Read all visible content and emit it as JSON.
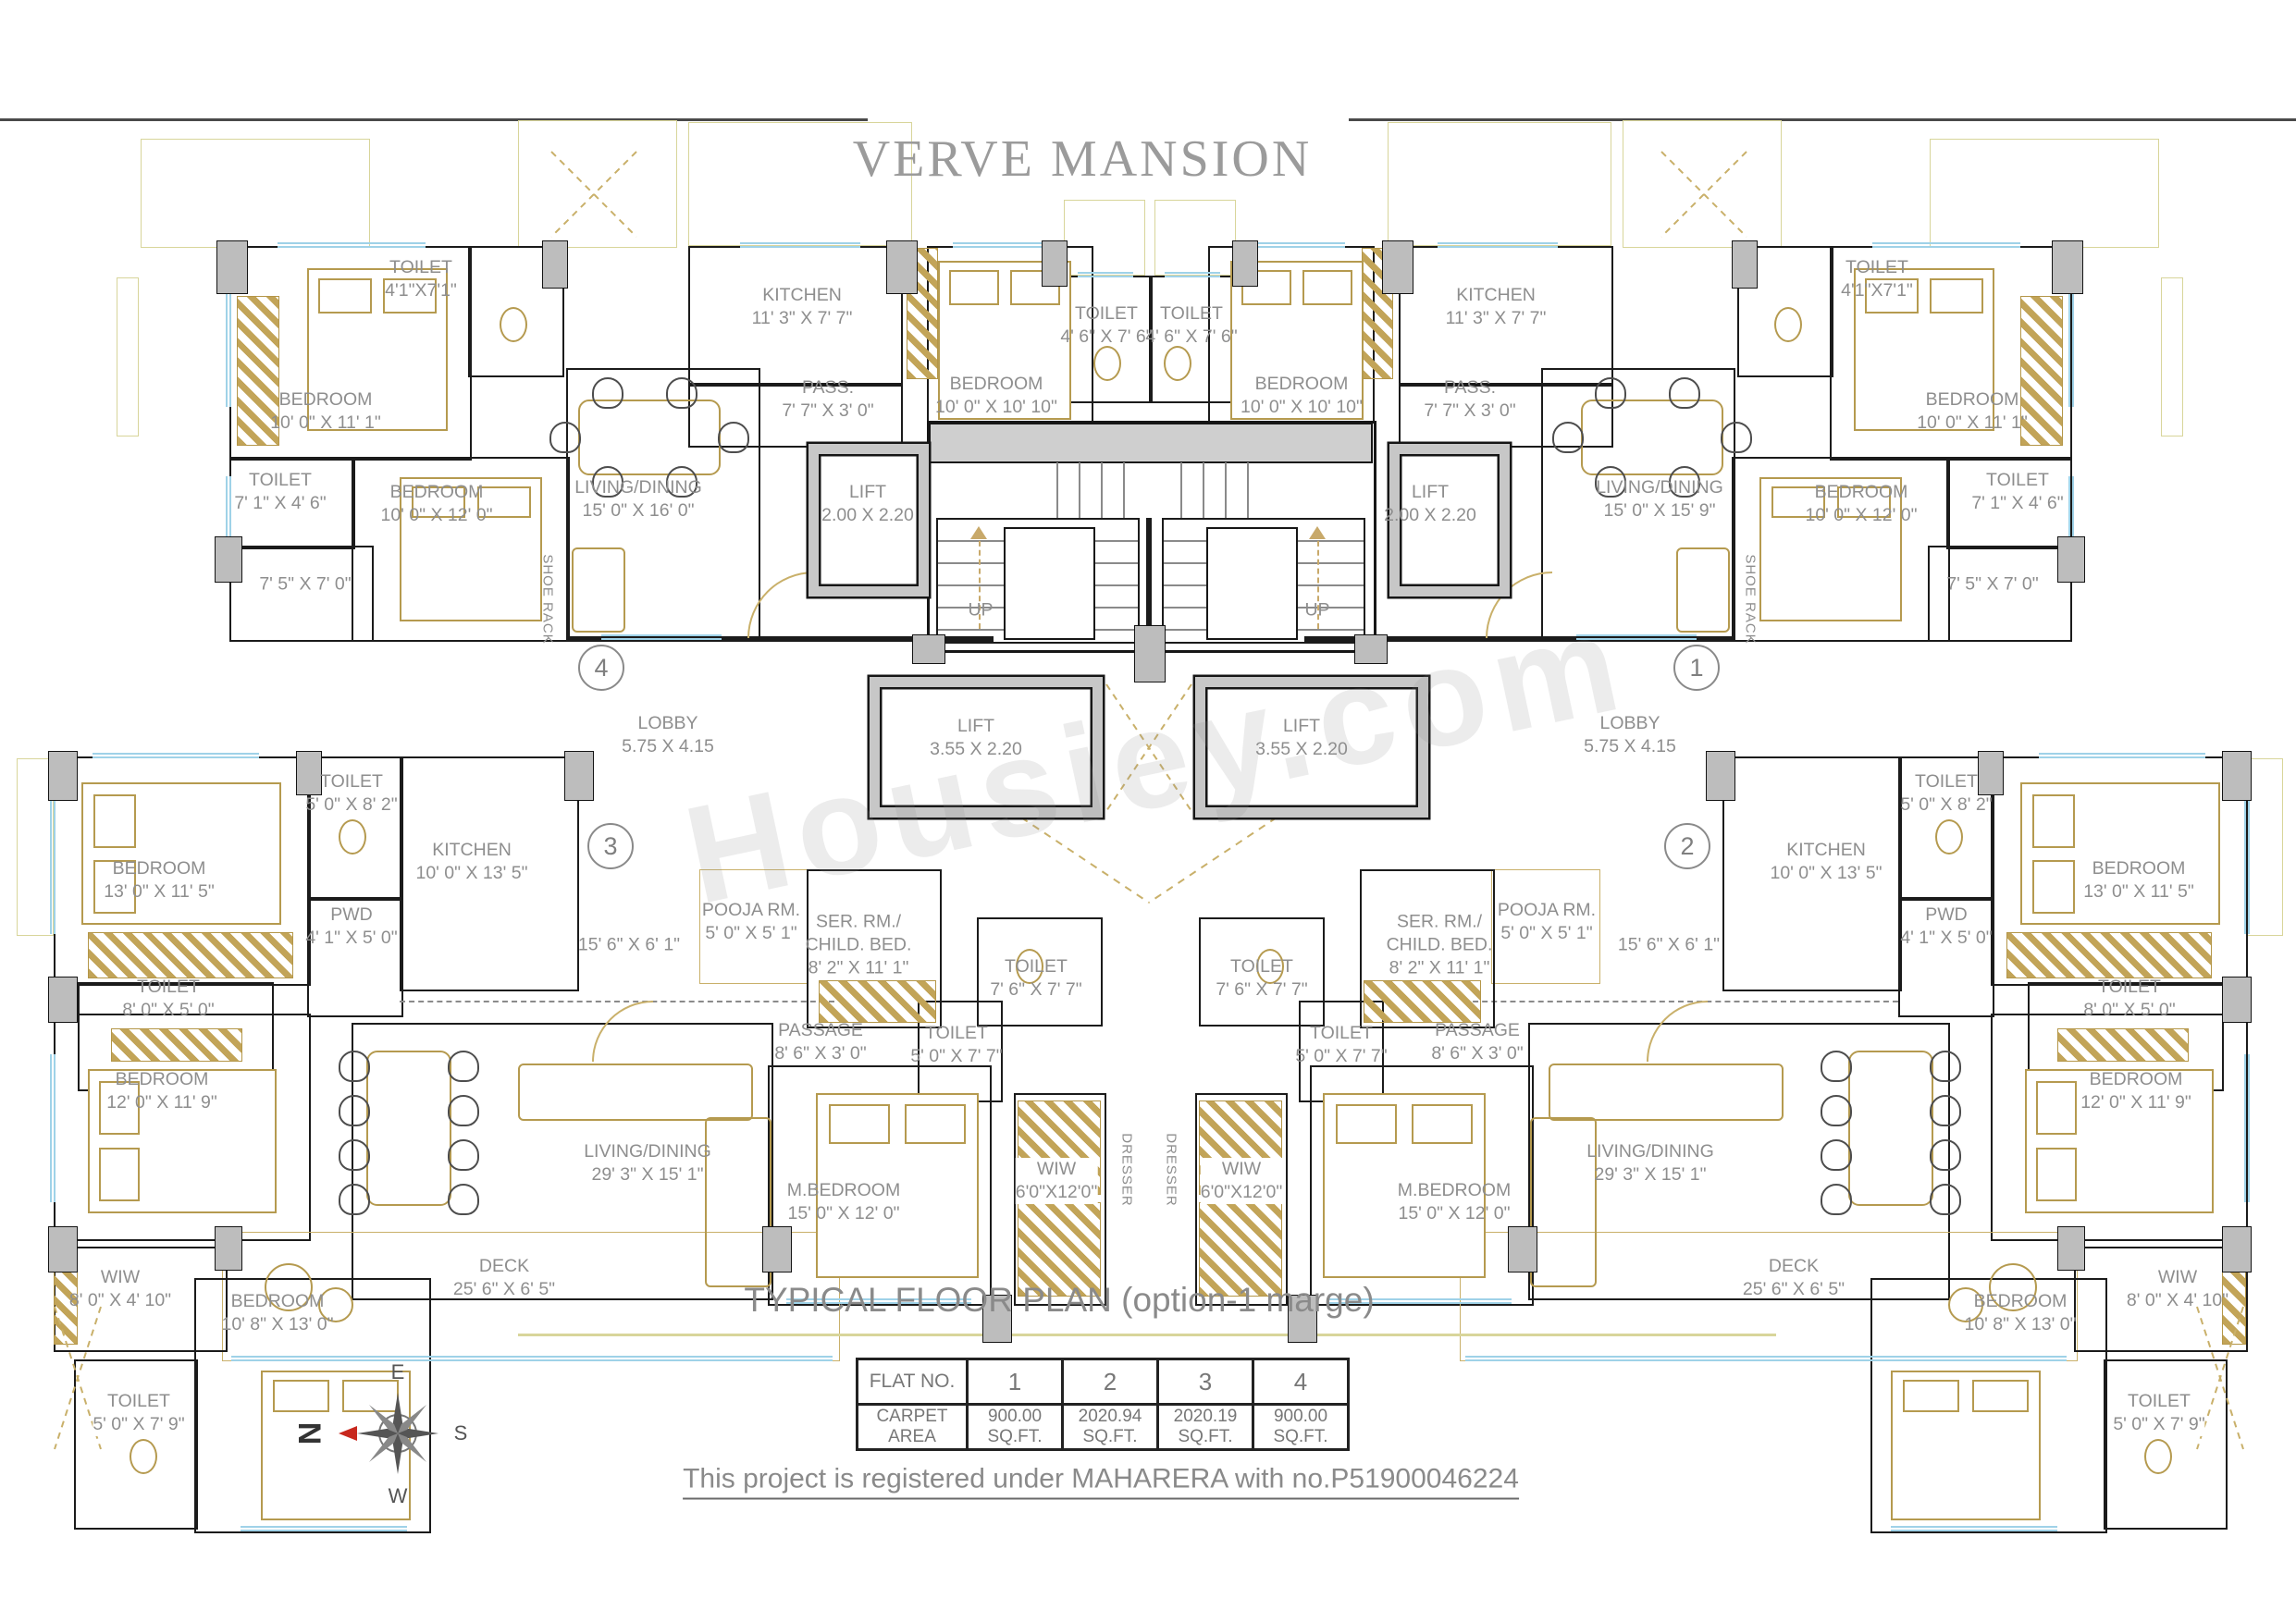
{
  "title": "VERVE MANSION",
  "plan_title": "TYPICAL FLOOR PLAN (option-1 marge)",
  "registration_note": "This project is registered under MAHARERA with no.P51900046224",
  "watermark": "Housiey.com",
  "colors": {
    "wall": "#1b1b1b",
    "furniture_tan": "#b59a4f",
    "window_blue": "#9fd2e8",
    "outline_pale": "#d8d59a",
    "label_gray": "#8e8e8e",
    "compass_arrow_red": "#c8281e"
  },
  "compass": {
    "east": "E",
    "south": "S",
    "west": "W",
    "north": "N"
  },
  "area_table": {
    "row1_header": "FLAT NO.",
    "row2_header": "CARPET AREA",
    "flats": [
      {
        "no": "1",
        "area": "900.00 SQ.FT."
      },
      {
        "no": "2",
        "area": "2020.94 SQ.FT."
      },
      {
        "no": "3",
        "area": "2020.19 SQ.FT."
      },
      {
        "no": "4",
        "area": "900.00 SQ.FT."
      }
    ]
  },
  "core": {
    "toilet_left": {
      "name": "TOILET",
      "dims": "4' 6\" X 7' 6\""
    },
    "toilet_right": {
      "name": "TOILET",
      "dims": "4' 6\" X 7' 6\""
    },
    "up_label": "UP",
    "shoe_rack": "SHOE RACK",
    "dresser": "DRESSER",
    "lobby_left": {
      "name": "LOBBY",
      "dims": "5.75 X 4.15"
    },
    "lobby_right": {
      "name": "LOBBY",
      "dims": "5.75 X 4.15"
    },
    "lift_left": {
      "name": "LIFT",
      "dims": "3.55 X 2.20"
    },
    "lift_right": {
      "name": "LIFT",
      "dims": "3.55 X 2.20"
    }
  },
  "flat4": {
    "marker": "4",
    "bedroom_a": {
      "name": "BEDROOM",
      "dims": "10' 0\" X 11' 1\""
    },
    "toilet_a": {
      "name": "TOILET",
      "dims": "4'1\"X7'1\""
    },
    "toilet_b": {
      "name": "TOILET",
      "dims": "7' 1\" X 4' 6\""
    },
    "dress_dims": "7' 5\" X 7' 0\"",
    "bedroom_b": {
      "name": "BEDROOM",
      "dims": "10' 0\" X 12' 0\""
    },
    "kitchen": {
      "name": "KITCHEN",
      "dims": "11' 3\" X 7' 7\""
    },
    "pass": {
      "name": "PASS.",
      "dims": "7' 7\" X 3' 0\""
    },
    "living": {
      "name": "LIVING/DINING",
      "dims": "15' 0\" X 16' 0\""
    },
    "lift": {
      "name": "LIFT",
      "dims": "2.00 X 2.20"
    },
    "bedroom_c": {
      "name": "BEDROOM",
      "dims": "10' 0\" X 10' 10\""
    }
  },
  "flat1": {
    "marker": "1",
    "bedroom_a": {
      "name": "BEDROOM",
      "dims": "10' 0\" X 11' 1\""
    },
    "toilet_a": {
      "name": "TOILET",
      "dims": "4'1\"X7'1\""
    },
    "toilet_b": {
      "name": "TOILET",
      "dims": "7' 1\" X 4' 6\""
    },
    "dress_dims": "7' 5\" X 7' 0\"",
    "bedroom_b": {
      "name": "BEDROOM",
      "dims": "10' 0\" X 12' 0\""
    },
    "kitchen": {
      "name": "KITCHEN",
      "dims": "11' 3\" X 7' 7\""
    },
    "pass": {
      "name": "PASS.",
      "dims": "7' 7\" X 3' 0\""
    },
    "living": {
      "name": "LIVING/DINING",
      "dims": "15' 0\" X 15' 9\""
    },
    "lift": {
      "name": "LIFT",
      "dims": "2.00 X 2.20"
    },
    "bedroom_c": {
      "name": "BEDROOM",
      "dims": "10' 0\" X 10' 10\""
    }
  },
  "flat3": {
    "marker": "3",
    "bedroom_a": {
      "name": "BEDROOM",
      "dims": "13' 0\" X 11' 5\""
    },
    "toilet_a": {
      "name": "TOILET",
      "dims": "5' 0\" X 8' 2\""
    },
    "kitchen": {
      "name": "KITCHEN",
      "dims": "10' 0\" X 13' 5\""
    },
    "pwd": {
      "name": "PWD",
      "dims": "4' 1\" X 5' 0\""
    },
    "toilet_b": {
      "name": "TOILET",
      "dims": "8' 0\" X 5' 0\""
    },
    "bedroom_b": {
      "name": "BEDROOM",
      "dims": "12' 0\" X 11' 9\""
    },
    "corridor_dims": "15' 6\" X 6' 1\"",
    "pooja": {
      "name": "POOJA RM.",
      "dims": "5' 0\" X 5' 1\""
    },
    "ser_rm": {
      "name1": "SER. RM./",
      "name2": "CHILD. BED.",
      "dims": "8' 2\" X 11' 1\""
    },
    "passage": {
      "name": "PASSAGE",
      "dims": "8' 6\" X 3' 0\""
    },
    "toilet_c": {
      "name": "TOILET",
      "dims": "7' 6\" X 7' 7\""
    },
    "toilet_d": {
      "name": "TOILET",
      "dims": "5' 0\" X 7' 7\""
    },
    "living": {
      "name": "LIVING/DINING",
      "dims": "29' 3\" X 15' 1\""
    },
    "m_bedroom": {
      "name": "M.BEDROOM",
      "dims": "15' 0\" X 12' 0\""
    },
    "wiw": {
      "name": "WIW",
      "dims": "6'0\"X12'0\""
    },
    "deck": {
      "name": "DECK",
      "dims": "25' 6\" X 6' 5\""
    },
    "wiw2": {
      "name": "WIW",
      "dims": "8' 0\" X 4' 10\""
    },
    "bedroom_c": {
      "name": "BEDROOM",
      "dims": "10' 8\" X 13' 0\""
    },
    "toilet_e": {
      "name": "TOILET",
      "dims": "5' 0\" X 7' 9\""
    }
  },
  "flat2": {
    "marker": "2",
    "bedroom_a": {
      "name": "BEDROOM",
      "dims": "13' 0\" X 11' 5\""
    },
    "toilet_a": {
      "name": "TOILET",
      "dims": "5' 0\" X 8' 2\""
    },
    "kitchen": {
      "name": "KITCHEN",
      "dims": "10' 0\" X 13' 5\""
    },
    "pwd": {
      "name": "PWD",
      "dims": "4' 1\" X 5' 0\""
    },
    "toilet_b": {
      "name": "TOILET",
      "dims": "8' 0\" X 5' 0\""
    },
    "bedroom_b": {
      "name": "BEDROOM",
      "dims": "12' 0\" X 11' 9\""
    },
    "corridor_dims": "15' 6\" X 6' 1\"",
    "pooja": {
      "name": "POOJA RM.",
      "dims": "5' 0\" X 5' 1\""
    },
    "ser_rm": {
      "name1": "SER. RM./",
      "name2": "CHILD. BED.",
      "dims": "8' 2\" X 11' 1\""
    },
    "passage": {
      "name": "PASSAGE",
      "dims": "8' 6\" X 3' 0\""
    },
    "toilet_c": {
      "name": "TOILET",
      "dims": "7' 6\" X 7' 7\""
    },
    "toilet_d": {
      "name": "TOILET",
      "dims": "5' 0\" X 7' 7\""
    },
    "living": {
      "name": "LIVING/DINING",
      "dims": "29' 3\" X 15' 1\""
    },
    "m_bedroom": {
      "name": "M.BEDROOM",
      "dims": "15' 0\" X 12' 0\""
    },
    "wiw": {
      "name": "WIW",
      "dims": "6'0\"X12'0\""
    },
    "deck": {
      "name": "DECK",
      "dims": "25' 6\" X 6' 5\""
    },
    "wiw2": {
      "name": "WIW",
      "dims": "8' 0\" X 4' 10\""
    },
    "bedroom_c": {
      "name": "BEDROOM",
      "dims": "10' 8\" X 13' 0\""
    },
    "toilet_e": {
      "name": "TOILET",
      "dims": "5' 0\" X 7' 9\""
    }
  }
}
